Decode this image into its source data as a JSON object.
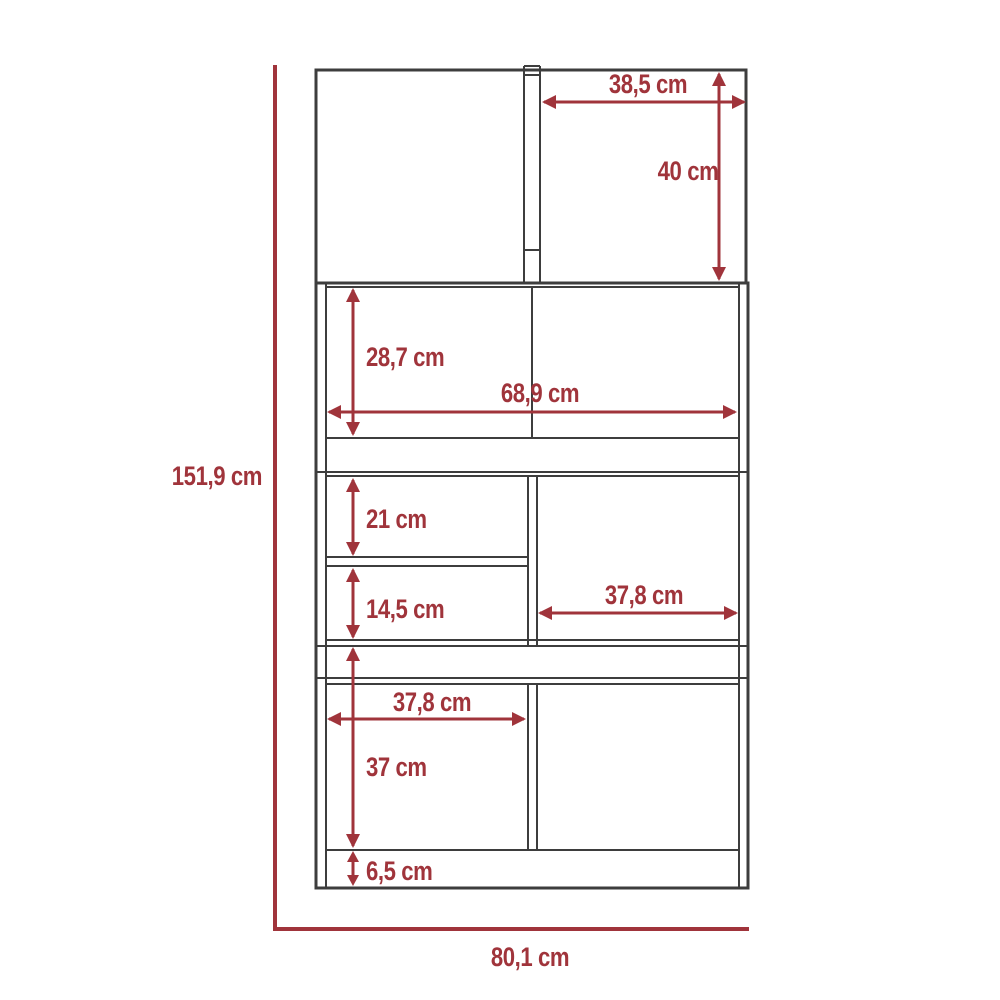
{
  "colors": {
    "dim": "#a0343b",
    "line": "#3d3d3d",
    "bg": "#ffffff"
  },
  "unit": "cm",
  "labels": {
    "overall_height": "151,9 cm",
    "overall_width": "80,1 cm",
    "top_door_width": "38,5 cm",
    "top_door_height": "40 cm",
    "upper_compartment_height": "28,7 cm",
    "interior_width": "68,9 cm",
    "top_drawer_height": "21 cm",
    "middle_drawer_height": "14,5 cm",
    "right_compartment_width": "37,8 cm",
    "bottom_left_compartment_width": "37,8 cm",
    "bottom_compartment_height": "37 cm",
    "base_height": "6,5 cm"
  }
}
